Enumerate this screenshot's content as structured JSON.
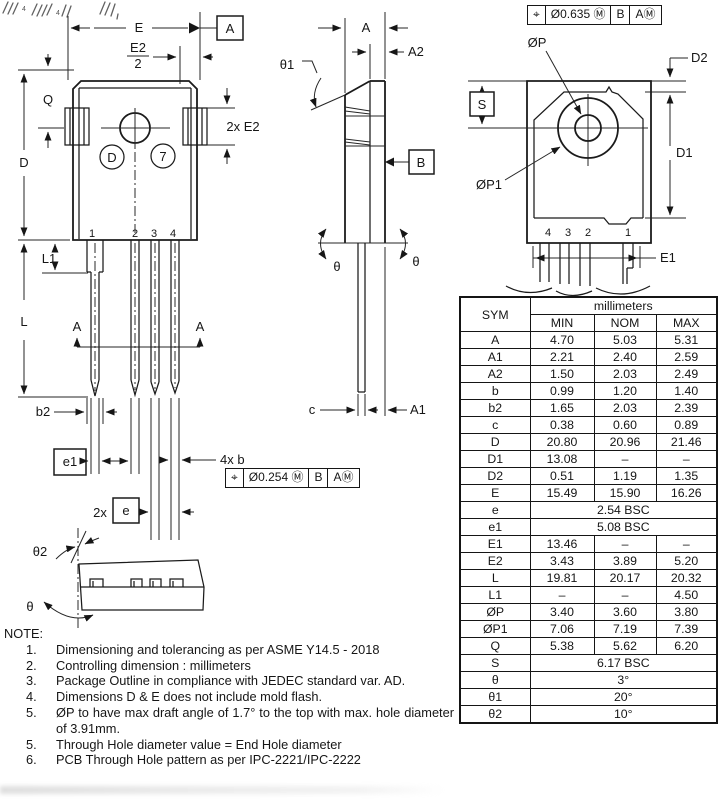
{
  "front_view": {
    "dim_E": "E",
    "dim_E2_num": "E2",
    "dim_E2_den": "2",
    "datum_a": "A",
    "dim_Q": "Q",
    "dim_D": "D",
    "dim_2xE2": "2x E2",
    "circle_d": "D",
    "circle_7": "7",
    "pins": [
      "1",
      "2",
      "3",
      "4"
    ],
    "dim_L1": "L1",
    "dim_L": "L",
    "section_a_left": "A",
    "section_a_right": "A",
    "dim_b2": "b2",
    "dim_e1": "e1",
    "dim_4xb": "4x b",
    "dim_2x": "2x",
    "dim_e": "e",
    "dim_theta2": "θ2",
    "dim_theta": "θ",
    "fcf": {
      "c1": "⌖",
      "c2": "Ø0.254 Ⓜ",
      "c3": "B",
      "c4": "AⓂ"
    }
  },
  "side_view": {
    "dim_A": "A",
    "dim_A2": "A2",
    "dim_theta1": "θ1",
    "datum_b": "B",
    "theta_left": "θ",
    "theta_right": "θ",
    "dim_c": "c",
    "dim_A1": "A1"
  },
  "back_view": {
    "fcf": {
      "c1": "⌖",
      "c2": "Ø0.635 Ⓜ",
      "c3": "B",
      "c4": "AⓂ"
    },
    "label_OP": "ØP",
    "label_OP1": "ØP1",
    "dim_D2": "D2",
    "dim_D1": "D1",
    "dim_S": "S",
    "dim_E1": "E1",
    "pins": [
      "4",
      "3",
      "2",
      "1"
    ]
  },
  "artifacts": {
    "t1": "4",
    "t2": "4"
  },
  "table": {
    "col_sym": "SYM",
    "col_unit": "millimeters",
    "col_min": "MIN",
    "col_nom": "NOM",
    "col_max": "MAX",
    "rows": [
      {
        "sym": "A",
        "min": "4.70",
        "nom": "5.03",
        "max": "5.31"
      },
      {
        "sym": "A1",
        "min": "2.21",
        "nom": "2.40",
        "max": "2.59"
      },
      {
        "sym": "A2",
        "min": "1.50",
        "nom": "2.03",
        "max": "2.49"
      },
      {
        "sym": "b",
        "min": "0.99",
        "nom": "1.20",
        "max": "1.40"
      },
      {
        "sym": "b2",
        "min": "1.65",
        "nom": "2.03",
        "max": "2.39"
      },
      {
        "sym": "c",
        "min": "0.38",
        "nom": "0.60",
        "max": "0.89"
      },
      {
        "sym": "D",
        "min": "20.80",
        "nom": "20.96",
        "max": "21.46"
      },
      {
        "sym": "D1",
        "min": "13.08",
        "nom": "–",
        "max": "–"
      },
      {
        "sym": "D2",
        "min": "0.51",
        "nom": "1.19",
        "max": "1.35"
      },
      {
        "sym": "E",
        "min": "15.49",
        "nom": "15.90",
        "max": "16.26"
      },
      {
        "sym": "e",
        "span": "2.54 BSC"
      },
      {
        "sym": "e1",
        "span": "5.08 BSC"
      },
      {
        "sym": "E1",
        "min": "13.46",
        "nom": "–",
        "max": "–"
      },
      {
        "sym": "E2",
        "min": "3.43",
        "nom": "3.89",
        "max": "5.20"
      },
      {
        "sym": "L",
        "min": "19.81",
        "nom": "20.17",
        "max": "20.32"
      },
      {
        "sym": "L1",
        "min": "–",
        "nom": "–",
        "max": "4.50"
      },
      {
        "sym": "ØP",
        "min": "3.40",
        "nom": "3.60",
        "max": "3.80"
      },
      {
        "sym": "ØP1",
        "min": "7.06",
        "nom": "7.19",
        "max": "7.39"
      },
      {
        "sym": "Q",
        "min": "5.38",
        "nom": "5.62",
        "max": "6.20"
      },
      {
        "sym": "S",
        "span": "6.17 BSC"
      },
      {
        "sym": "θ",
        "span": "3°"
      },
      {
        "sym": "θ1",
        "span": "20°"
      },
      {
        "sym": "θ2",
        "span": "10°"
      }
    ]
  },
  "notes": {
    "title": "NOTE:",
    "items": [
      {
        "num": "1.",
        "text": "Dimensioning and tolerancing as per ASME Y14.5 - 2018"
      },
      {
        "num": "2.",
        "text": "Controlling dimension : millimeters"
      },
      {
        "num": "3.",
        "text": "Package Outline in compliance with JEDEC standard var. AD."
      },
      {
        "num": "4.",
        "text": "Dimensions D & E does not include mold flash."
      },
      {
        "num": "5.",
        "text": "ØP to have max draft angle of 1.7° to the top with max. hole diameter of 3.91mm."
      },
      {
        "num": "5.",
        "text": "Through Hole diameter value = End Hole diameter"
      },
      {
        "num": "6.",
        "text": "PCB Through Hole pattern as per IPC-2221/IPC-2222"
      }
    ]
  }
}
